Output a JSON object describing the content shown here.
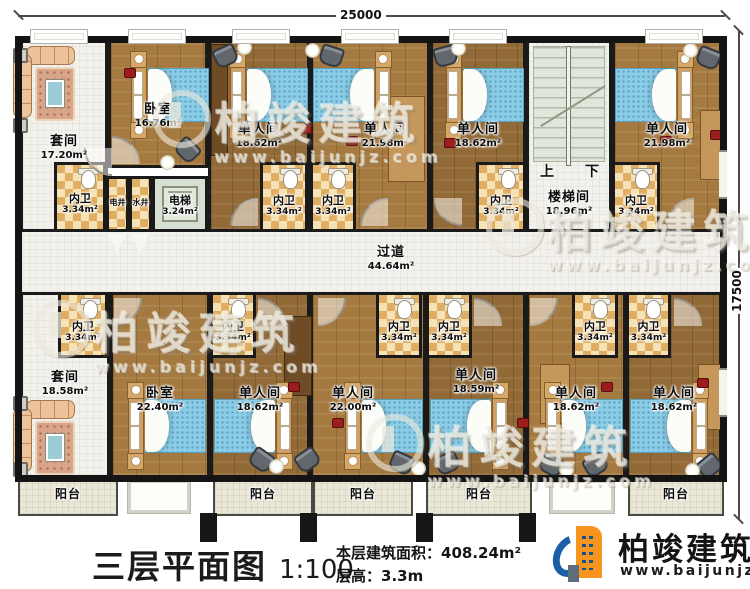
{
  "dims": {
    "width": "25000",
    "height": "17500"
  },
  "rooms": {
    "suite_top": {
      "name": "套间",
      "area": "17.20m²"
    },
    "bedroom_top": {
      "name": "卧室",
      "area": "16.76m²"
    },
    "bath_suite_top": {
      "name": "内卫",
      "area": "3.34m²"
    },
    "shaft_elec": {
      "name": "电井"
    },
    "shaft_water": {
      "name": "水井"
    },
    "elevator": {
      "name": "电梯",
      "area": "3.24m²"
    },
    "single_top_1": {
      "name": "单人间",
      "area": "18.62m²"
    },
    "bath_top_1": {
      "name": "内卫",
      "area": "3.34m²"
    },
    "single_top_2": {
      "name": "单人间",
      "area": "21.98m²"
    },
    "bath_top_2": {
      "name": "内卫",
      "area": "3.34m²"
    },
    "single_top_3": {
      "name": "单人间",
      "area": "18.62m²"
    },
    "bath_top_3": {
      "name": "内卫",
      "area": "3.34m²"
    },
    "stairwell": {
      "name": "楼梯间",
      "area": "18.96m²",
      "up": "上",
      "down": "下"
    },
    "single_top_4": {
      "name": "单人间",
      "area": "21.98m²"
    },
    "bath_top_4": {
      "name": "内卫",
      "area": "3.34m²"
    },
    "corridor": {
      "name": "过道",
      "area": "44.64m²"
    },
    "suite_bottom": {
      "name": "套间",
      "area": "18.58m²"
    },
    "bath_bottom_1": {
      "name": "内卫",
      "area": "3.34m²"
    },
    "bedroom_bottom": {
      "name": "卧室",
      "area": "22.40m²"
    },
    "bath_bottom_2": {
      "name": "内卫",
      "area": "3.34m²"
    },
    "single_bottom_1": {
      "name": "单人间",
      "area": "18.62m²"
    },
    "single_bottom_2": {
      "name": "单人间",
      "area": "22.00m²"
    },
    "bath_bottom_3": {
      "name": "内卫",
      "area": "3.34m²"
    },
    "single_bottom_3": {
      "name": "单人间",
      "area": "18.59m²"
    },
    "bath_bottom_4": {
      "name": "内卫",
      "area": "3.34m²"
    },
    "single_bottom_4": {
      "name": "单人间",
      "area": "18.62m²"
    },
    "bath_bottom_5": {
      "name": "内卫",
      "area": "3.34m²"
    },
    "single_bottom_5": {
      "name": "单人间",
      "area": "18.62m²"
    },
    "bath_bottom_6": {
      "name": "内卫",
      "area": "3.34m²"
    }
  },
  "balconies": [
    {
      "label": "阳台"
    },
    {
      "label": "阳台"
    },
    {
      "label": "阳台"
    },
    {
      "label": "阳台"
    },
    {
      "label": "阳台"
    }
  ],
  "title": {
    "plan": "三层平面图",
    "scale": "1:100",
    "area_label": "本层建筑面积：",
    "area_value": "408.24m²",
    "height_label": "层高：",
    "height_value": "3.3m"
  },
  "brand": {
    "name": "柏竣建筑",
    "site": "www.baijunjz.com"
  },
  "watermark": {
    "text": "柏竣建筑",
    "site": "www.baijunjz.com"
  },
  "colors": {
    "wall": "#1a1a1a",
    "wood": "#a57a41",
    "checker": "#dfae62",
    "brand_blue": "#1b5fa7",
    "brand_orange": "#f7941e"
  }
}
